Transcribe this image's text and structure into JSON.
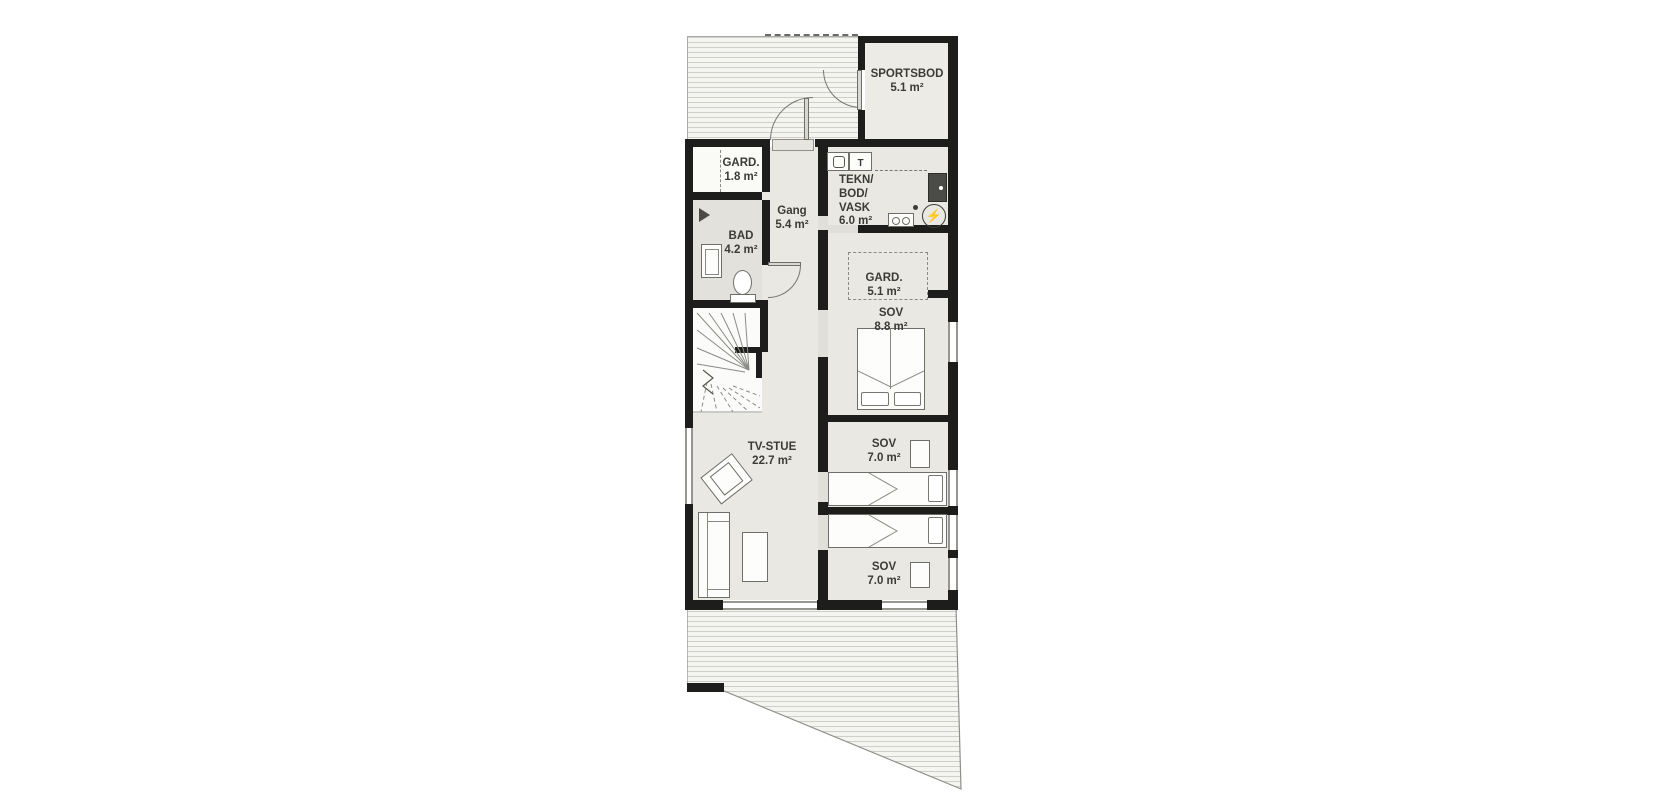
{
  "plan": {
    "type": "floor-plan",
    "rooms": {
      "sportsbod": {
        "name": "SPORTSBOD",
        "area": "5.1 m²"
      },
      "gard_entry": {
        "name": "GARD.",
        "area": "1.8 m²"
      },
      "gang": {
        "name": "Gang",
        "area": "5.4 m²"
      },
      "tekn": {
        "line1": "TEKN/",
        "line2": "BOD/",
        "line3": "VASK",
        "area": "6.0 m²"
      },
      "bad": {
        "name": "BAD",
        "area": "4.2 m²"
      },
      "gard_sov": {
        "name": "GARD.",
        "area": "5.1 m²"
      },
      "sov_main": {
        "name": "SOV",
        "area": "8.8 m²"
      },
      "tv_stue": {
        "name": "TV-STUE",
        "area": "22.7 m²"
      },
      "sov_mid": {
        "name": "SOV",
        "area": "7.0 m²"
      },
      "sov_bottom": {
        "name": "SOV",
        "area": "7.0 m²"
      }
    },
    "icons": {
      "dryer_letter": "T",
      "bolt": "⚡"
    },
    "colors": {
      "wall": "#1d1d1b",
      "floor": "#e9e8e3",
      "deck_line": "#cfcfca",
      "text": "#3b3b37"
    }
  }
}
